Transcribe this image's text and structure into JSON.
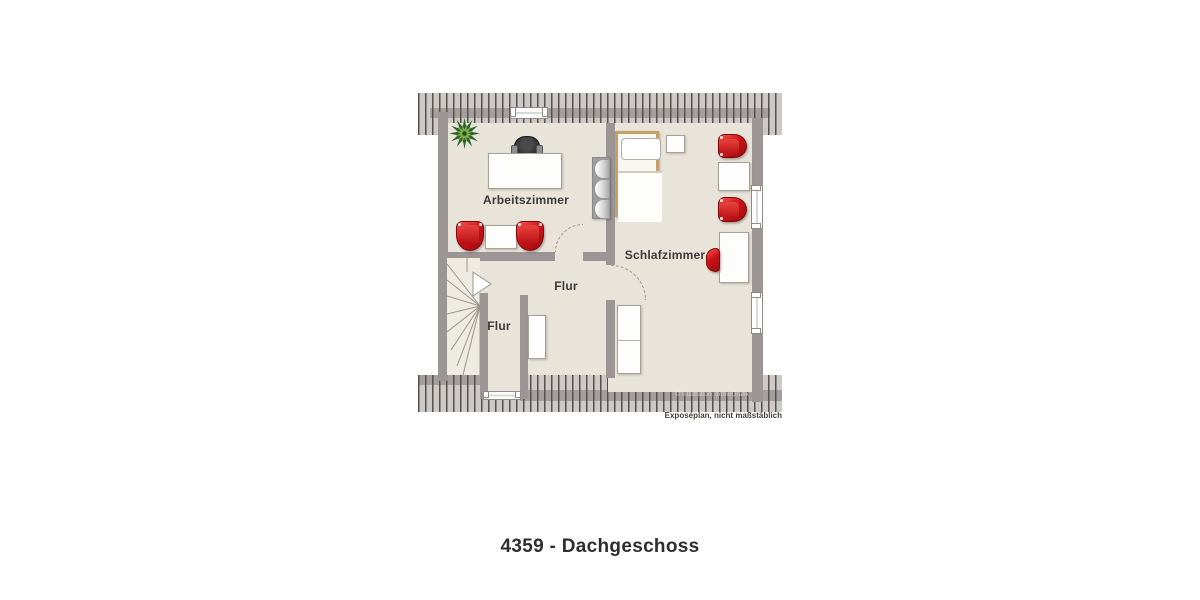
{
  "title": "4359 - Dachgeschoss",
  "disclaimer": "Exposéplan, nicht maßstäblich",
  "watermark": "© Illustration: ImmoGrafik",
  "rooms": {
    "arbeitszimmer": {
      "label": "Arbeitszimmer"
    },
    "schlafzimmer": {
      "label": "Schlafzimmer"
    },
    "flur_links": {
      "label": "Flur"
    },
    "flur_mitte": {
      "label": "Flur"
    }
  },
  "colors": {
    "floor": "#e9e4da",
    "wall": "#9c9595",
    "roof_hatch_bg": "#cdc9c6",
    "roof_hatch_line": "#55504c",
    "accent_red": "#cc1318",
    "bed_frame": "#c2a067",
    "plant_green_dark": "#2c632a",
    "plant_green_light": "#7fae46"
  },
  "furniture": [
    "plant",
    "desk",
    "office-chair",
    "tub-chair",
    "side-table",
    "shelf",
    "single-bed",
    "nightstand",
    "armchair",
    "coffee-table",
    "writing-desk",
    "desk-chair",
    "cabinet",
    "wardrobe",
    "stairs"
  ]
}
